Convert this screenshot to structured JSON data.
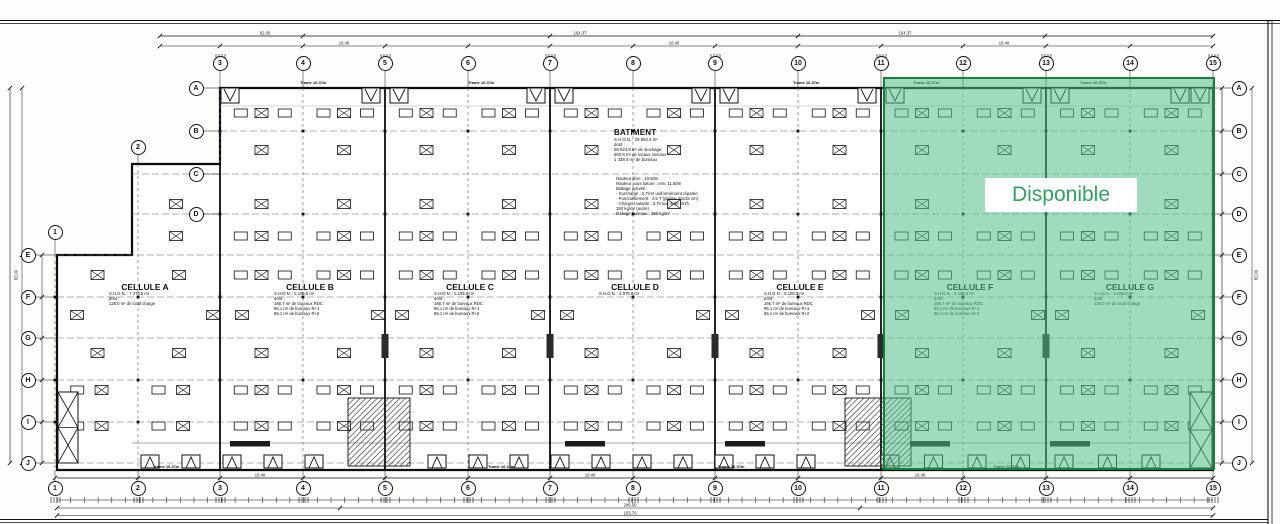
{
  "available": {
    "label": "Disponible"
  },
  "colors": {
    "available_fill": "rgba(80,190,135,0.55)",
    "available_border": "#15803d",
    "available_text": "#2ba45e",
    "ink": "#111111"
  },
  "grid": {
    "columns": [
      {
        "n": 1,
        "x": 55
      },
      {
        "n": 2,
        "x": 138
      },
      {
        "n": 3,
        "x": 220
      },
      {
        "n": 4,
        "x": 303
      },
      {
        "n": 5,
        "x": 385
      },
      {
        "n": 6,
        "x": 468
      },
      {
        "n": 7,
        "x": 550
      },
      {
        "n": 8,
        "x": 633
      },
      {
        "n": 9,
        "x": 715
      },
      {
        "n": 10,
        "x": 798
      },
      {
        "n": 11,
        "x": 881
      },
      {
        "n": 12,
        "x": 963
      },
      {
        "n": 13,
        "x": 1046
      },
      {
        "n": 14,
        "x": 1130
      },
      {
        "n": 15,
        "x": 1213
      }
    ],
    "rows": [
      {
        "l": "A",
        "y": 88
      },
      {
        "l": "B",
        "y": 131
      },
      {
        "l": "C",
        "y": 174
      },
      {
        "l": "D",
        "y": 214
      },
      {
        "l": "E",
        "y": 255
      },
      {
        "l": "F",
        "y": 297
      },
      {
        "l": "G",
        "y": 338
      },
      {
        "l": "H",
        "y": 380
      },
      {
        "l": "I",
        "y": 422
      },
      {
        "l": "J",
        "y": 463
      }
    ]
  },
  "batiment": {
    "title": "BATIMENT",
    "lines": [
      "S.H.O.N. : 29 983.6 m²",
      "dont :",
      "28 924.8 m² de stockage",
      "560.8 m² de locaux sociaux",
      "1 438.4 m² de bureaux"
    ]
  },
  "specs": {
    "lines": [
      "Hauteur libre : 10.50m",
      "Hauteur sous toiture : env. 11.50m",
      "Dallage activité :",
      "- Surcharge : 5 T/m² uniformément répartie",
      "- Ponctuellement : 4.5 T (platine 15x15 cm)",
      "- Charge roulante : 3 T/roue à 35 km/h",
      "  150 kg/m² (autre)",
      "Dallage bureaux : 350 kg/m²"
    ]
  },
  "cells": [
    {
      "name": "CELLULE A",
      "x": 145,
      "lines": [
        "S.H.O.N. : 7 373.5 m²",
        "dont :",
        "128.0 m² de local charge"
      ]
    },
    {
      "name": "CELLULE B",
      "x": 310,
      "lines": [
        "S.H.O.N. : 5 195.5 m²",
        "dont :",
        "166.7 m² de bureaux RDC",
        "96.1 m² de bureaux R+1",
        "96.1 m² de bureaux R+2"
      ]
    },
    {
      "name": "CELLULE C",
      "x": 470,
      "lines": [
        "S.H.O.N. : 5 195.0 m²",
        "dont :",
        "166.7 m² de bureaux RDC",
        "96.1 m² de bureaux R+1",
        "96.1 m² de bureaux R+2"
      ]
    },
    {
      "name": "CELLULE D",
      "x": 635,
      "lines": [
        "S.H.O.N. : 4 876.0 m²"
      ]
    },
    {
      "name": "CELLULE E",
      "x": 800,
      "lines": [
        "S.H.O.N. : 5 195.5 m²",
        "dont :",
        "166.7 m² de bureaux RDC",
        "96.1 m² de bureaux R+1",
        "96.1 m² de bureaux R+2"
      ]
    },
    {
      "name": "CELLULE F",
      "x": 970,
      "lines": [
        "S.H.O.N. : 5 195.5 m²",
        "dont :",
        "166.7 m² de bureaux RDC",
        "96.1 m² de bureaux R+1",
        "96.1 m² de bureaux R+2"
      ]
    },
    {
      "name": "CELLULE G",
      "x": 1130,
      "lines": [
        "S.A.D.A. : 5 686.0 m²",
        "dont :",
        "128.0 m² de local charge"
      ]
    }
  ],
  "trame": {
    "text": "Trame 16.37m",
    "top_xs": [
      312,
      480,
      805,
      925,
      1092
    ],
    "bottom_xs": [
      165,
      500,
      730,
      1005
    ]
  },
  "dim_labels": [
    {
      "t": "82.00",
      "x": 265,
      "y": 33
    },
    {
      "t": "164.37",
      "x": 580,
      "y": 33
    },
    {
      "t": "164.37",
      "x": 905,
      "y": 33
    },
    {
      "t": "16.40",
      "x": 344,
      "y": 43
    },
    {
      "t": "16.40",
      "x": 674,
      "y": 43
    },
    {
      "t": "16.40",
      "x": 1004,
      "y": 43
    },
    {
      "t": "16.40",
      "x": 260,
      "y": 475
    },
    {
      "t": "16.40",
      "x": 590,
      "y": 475
    },
    {
      "t": "16.40",
      "x": 920,
      "y": 475
    },
    {
      "t": "246.50",
      "x": 630,
      "y": 505
    },
    {
      "t": "163.70",
      "x": 630,
      "y": 513
    },
    {
      "t": "82.00",
      "x": 16,
      "y": 275,
      "rot": -90
    },
    {
      "t": "82.00",
      "x": 1256,
      "y": 275,
      "rot": -90
    }
  ]
}
